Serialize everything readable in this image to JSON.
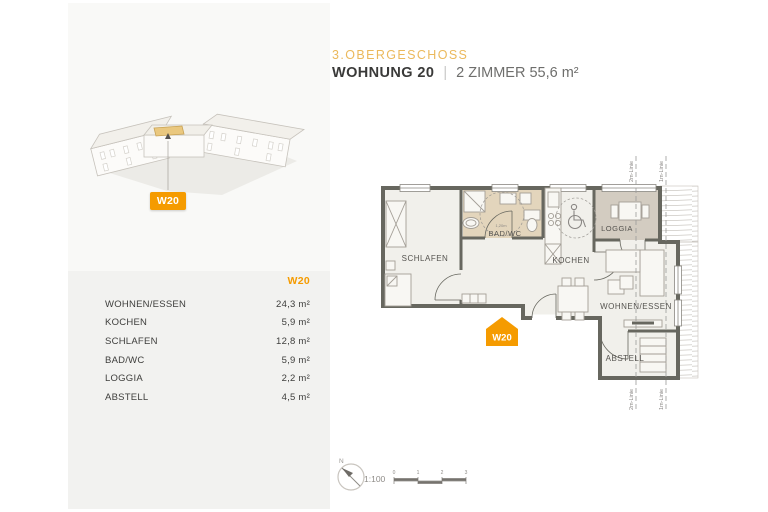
{
  "colors": {
    "orange": "#f59b00",
    "gold": "#ebb95c",
    "wall": "#67675f",
    "bad_fill": "#e3d5bc",
    "loggia_fill": "#d3ccc1",
    "room_fill": "#f1f0eb"
  },
  "header": {
    "floor_label": "3.OBERGESCHOSS",
    "apartment_label": "WOHNUNG 20",
    "separator": "|",
    "details": "2 ZIMMER 55,6 m²"
  },
  "sidebar": {
    "marker_label": "W20",
    "table": {
      "header": "W20",
      "rows": [
        {
          "label": "WOHNEN/ESSEN",
          "value": "24,3 m²"
        },
        {
          "label": "KOCHEN",
          "value": "5,9 m²"
        },
        {
          "label": "SCHLAFEN",
          "value": "12,8 m²"
        },
        {
          "label": "BAD/WC",
          "value": "5,9 m²"
        },
        {
          "label": "LOGGIA",
          "value": "2,2 m²"
        },
        {
          "label": "ABSTELL",
          "value": "4,5 m²"
        }
      ]
    }
  },
  "floorplan": {
    "marker_label": "W20",
    "rooms": [
      "SCHLAFEN",
      "BAD/WC",
      "KOCHEN",
      "LOGGIA",
      "WOHNEN/ESSEN",
      "ABSTELL"
    ],
    "radius_label": "1,20m",
    "guides": {
      "line2m": "2m-Linie",
      "line1m": "1m-Linie"
    },
    "north_label": "N",
    "scale_ratio": "1:100",
    "scale_ticks": [
      "0",
      "1",
      "2",
      "3"
    ]
  }
}
